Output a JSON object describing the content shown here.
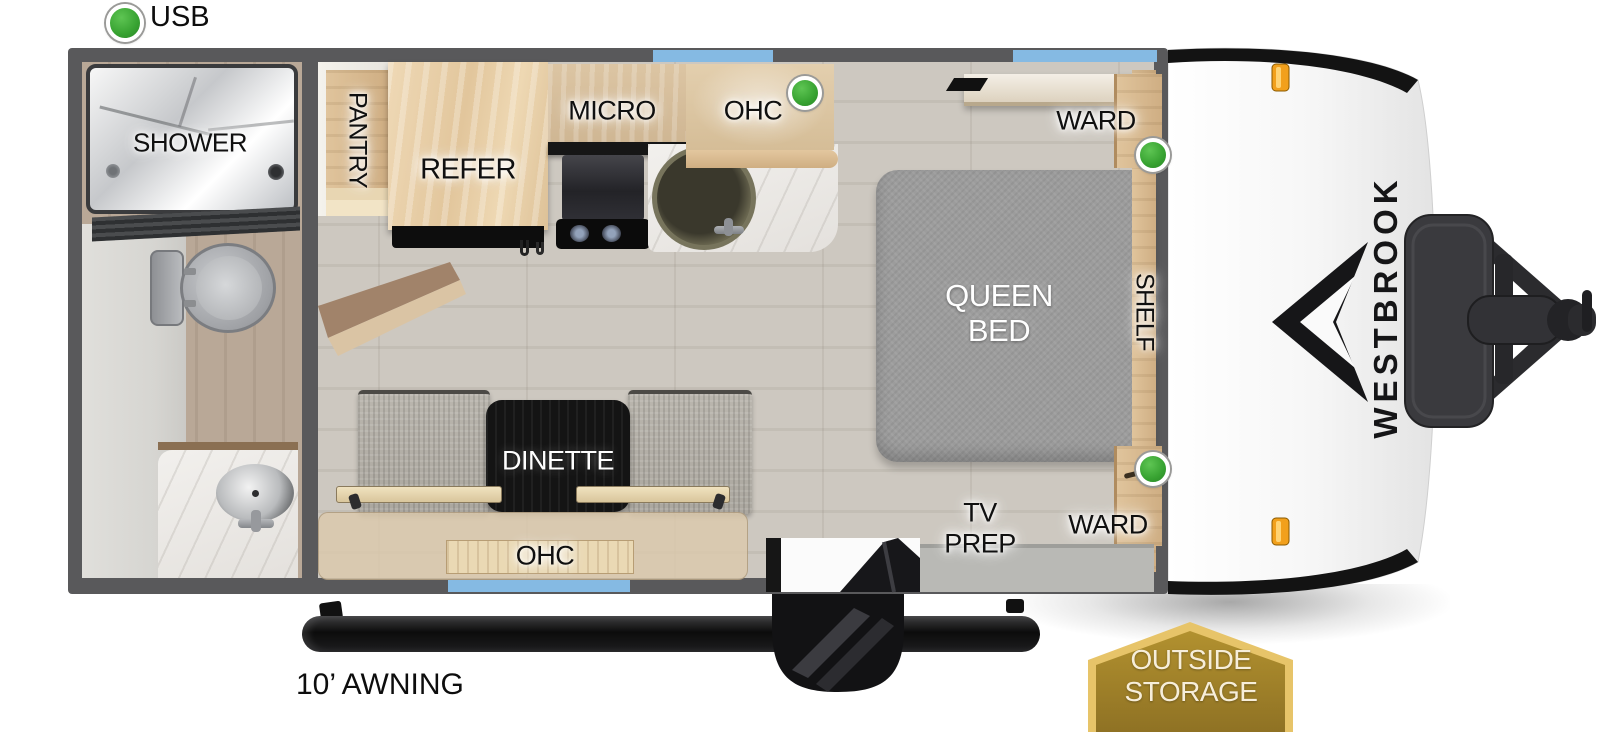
{
  "legend": {
    "usb_label": "USB"
  },
  "rooms": {
    "shower": "SHOWER",
    "pantry": "PANTRY",
    "refer": "REFER",
    "micro": "MICRO",
    "ohc_kitchen": "OHC",
    "ward_top": "WARD",
    "ward_bottom": "WARD",
    "shelf": "SHELF",
    "queen_line1": "QUEEN",
    "queen_line2": "BED",
    "dinette": "DINETTE",
    "ohc_dinette": "OHC",
    "tv_prep_line1": "TV",
    "tv_prep_line2": "PREP"
  },
  "exterior": {
    "awning_label": "10’ AWNING",
    "brand": "WESTBROOK",
    "storage_line1": "OUTSIDE",
    "storage_line2": "STORAGE"
  },
  "colors": {
    "wall": "#59595b",
    "window_blue": "#85bae3",
    "usb_green": "#37a231",
    "marker_orange": "#f2a01c",
    "badge_gold": "#a8872f",
    "badge_border": "#e7c469"
  }
}
